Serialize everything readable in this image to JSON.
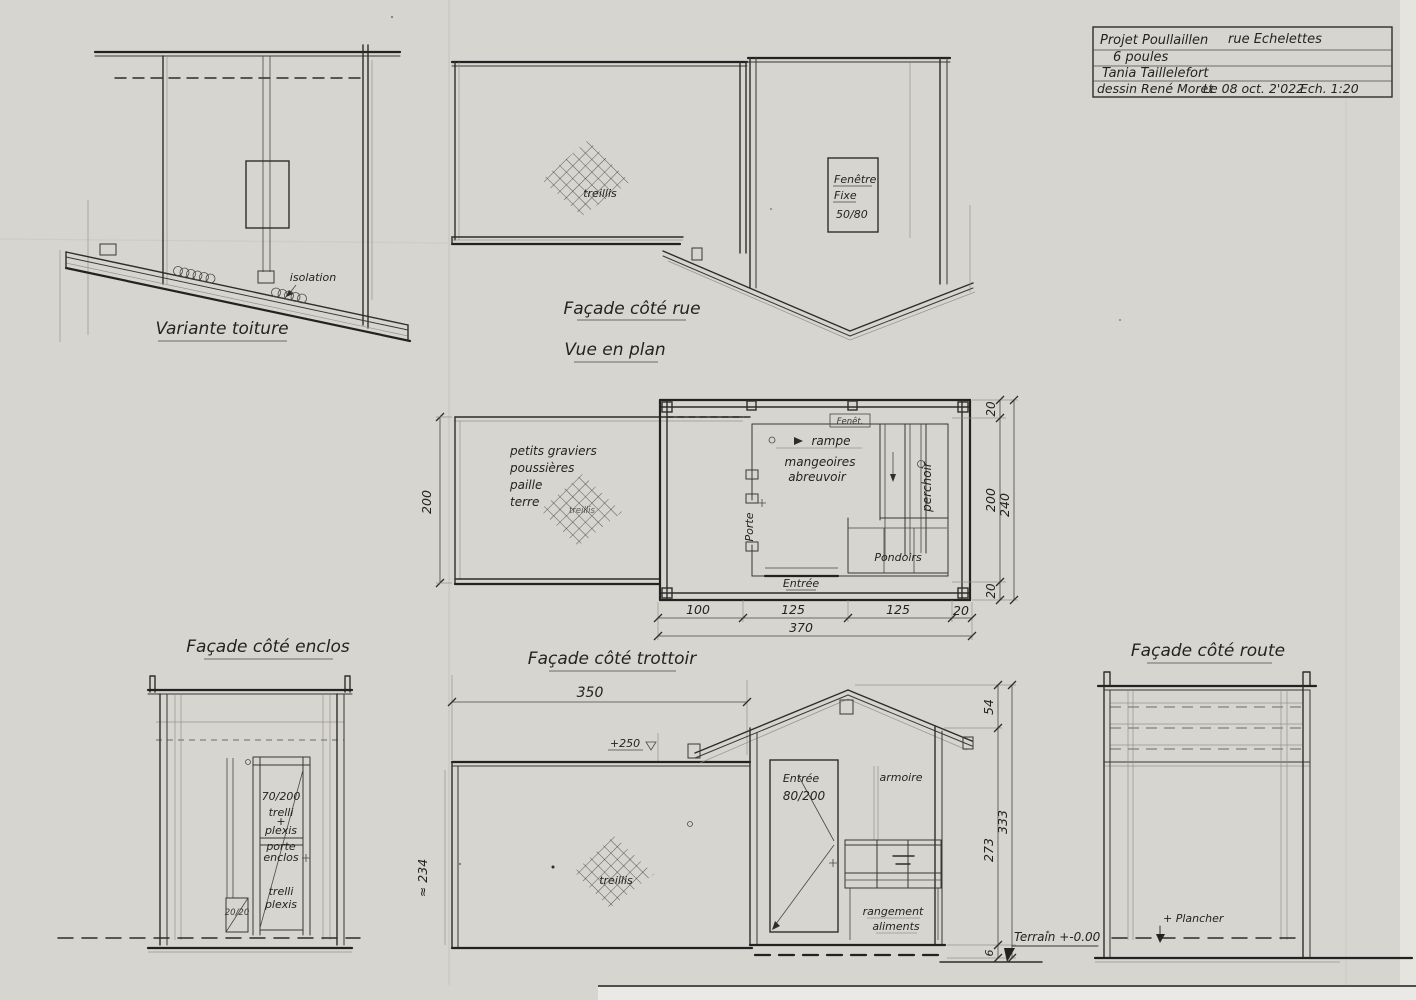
{
  "colors": {
    "paper": "#d7d5d0",
    "ink": "#2e2d2b"
  },
  "title_block": {
    "project": "Projet Poullaillen",
    "location": "rue Echelettes",
    "capacity": "6 poules",
    "client": "Tania Taillelefort",
    "author": "dessin René Moret",
    "date": "Le 08 oct. 2'022",
    "scale": "Ech. 1:20"
  },
  "views": {
    "variante_toiture": {
      "caption": "Variante toiture",
      "isolation": "isolation"
    },
    "facade_rue": {
      "caption": "Façade côté rue",
      "treillis": "treillis"
    },
    "pignon_rue": {
      "fenetre_l1": "Fenêtre",
      "fenetre_l2": "Fixe",
      "fenetre_l3": "50/80"
    },
    "vue_en_plan": {
      "caption": "Vue en plan",
      "litiere_l1": "petits graviers",
      "litiere_l2": "poussières",
      "litiere_l3": "paille",
      "litiere_l4": "terre",
      "treillis": "treillis",
      "fenet": "Fenêt.",
      "rampe": "rampe",
      "mangeoires": "mangeoires",
      "abreuvoir": "abreuvoir",
      "perchoir": "perchoir",
      "pondoirs": "Pondoirs",
      "entree": "Entrée",
      "porte": "Porte",
      "dim_left": "200",
      "dim_right_top": "20",
      "dim_right_inner": "200",
      "dim_right_outer": "240",
      "dim_right_bottom": "20",
      "dim_b1": "100",
      "dim_b2": "125",
      "dim_b3": "125",
      "dim_b4": "20",
      "dim_total": "370"
    },
    "facade_enclos": {
      "caption": "Façade côté enclos",
      "door_l1": "70/200",
      "door_l2": "trelli",
      "door_plus": "+",
      "door_l3": "plexis",
      "door_l4": "porte",
      "door_l5": "enclos",
      "door_l6": "trelli",
      "door_l7": "plexis",
      "post": "20/20"
    },
    "facade_trottoir": {
      "caption": "Façade côté trottoir",
      "dim_width": "350",
      "level": "+250",
      "dim_height": "≈ 234",
      "treillis": "treillis"
    },
    "pignon_trottoir": {
      "entree_l1": "Entrée",
      "entree_l2": "80/200",
      "armoire": "armoire",
      "rangement_l1": "rangement",
      "rangement_l2": "aliments",
      "dim_roof": "54",
      "dim_wall": "273",
      "dim_total": "333",
      "dim_base": "6",
      "terrain": "Terrain +-0.00"
    },
    "facade_route": {
      "caption": "Façade côté route",
      "plancher": "+ Plancher"
    }
  }
}
